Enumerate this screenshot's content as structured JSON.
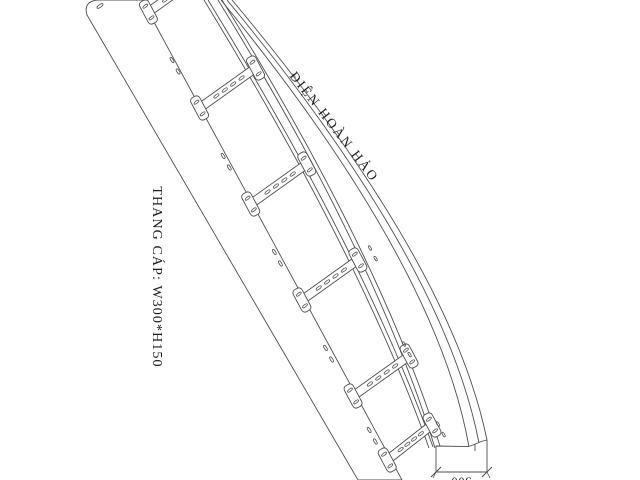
{
  "page": {
    "background_color": "#ffffff",
    "line_color": "#4f4f4f",
    "text_color": "#1c1c1c"
  },
  "drawing": {
    "subject": "cable-ladder-perspective-line-drawing",
    "brand_label": "ĐIỆN HOÀN HẢO",
    "spec_label": "THANG CÁP: W300*H150",
    "dimension": {
      "width_value": "300"
    }
  }
}
